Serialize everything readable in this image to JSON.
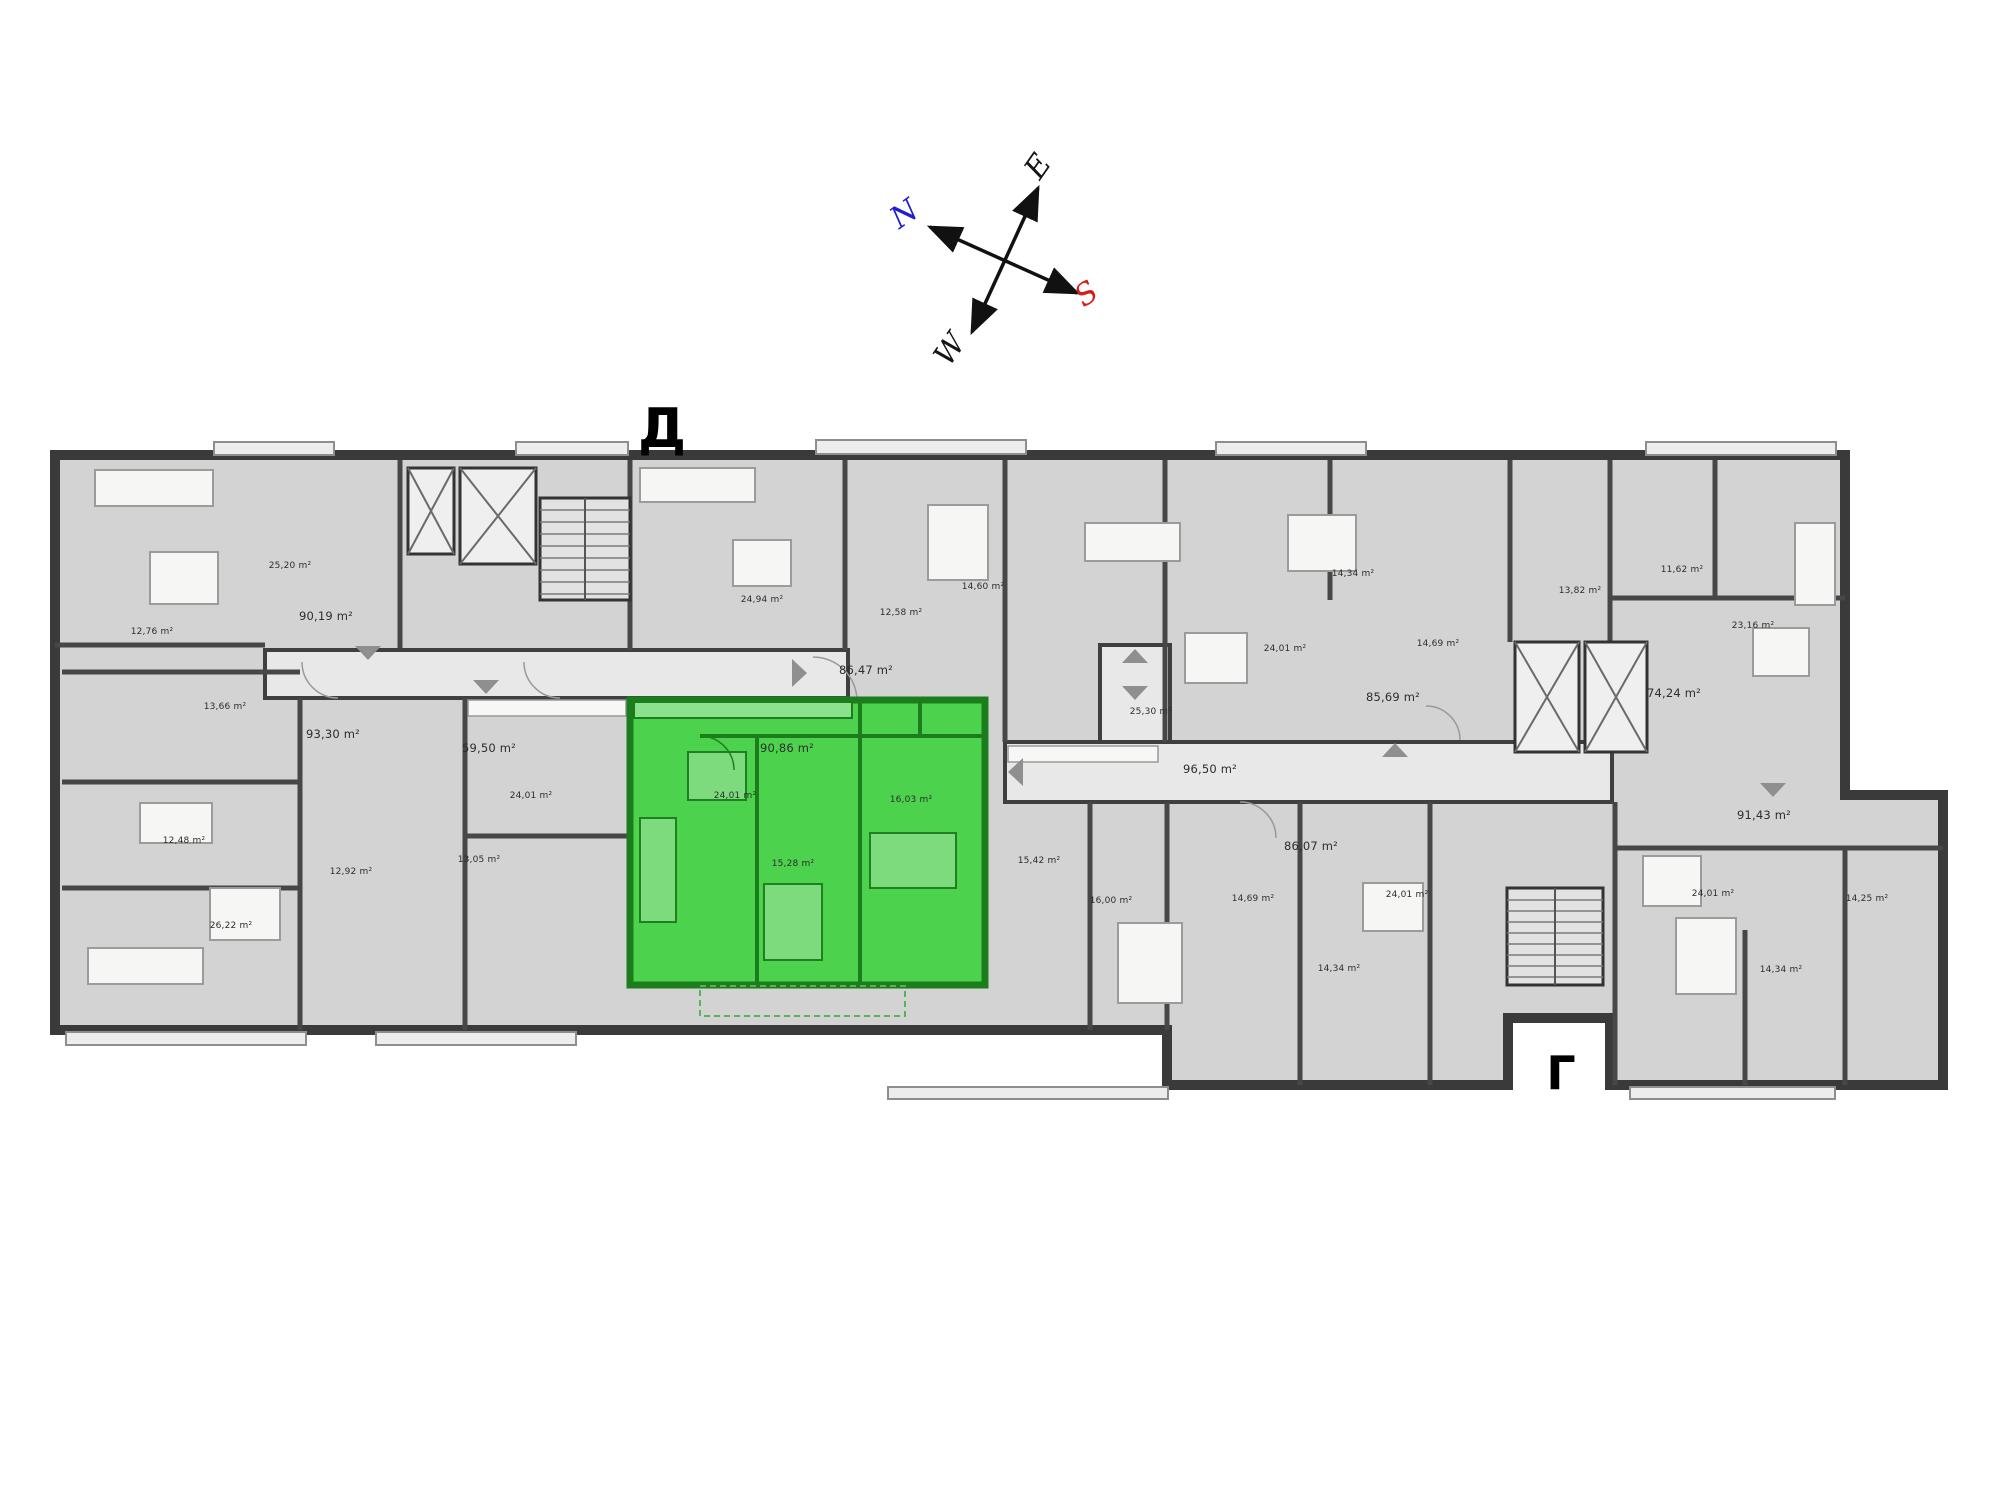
{
  "entrances": {
    "top_label": "Д",
    "bottom_label": "Г"
  },
  "compass": {
    "north": {
      "label": "N",
      "color": "#1f1fd1"
    },
    "east": {
      "label": "E",
      "color": "#151515"
    },
    "south": {
      "label": "S",
      "color": "#d11f1f"
    },
    "west": {
      "label": "W",
      "color": "#151515"
    }
  },
  "palette": {
    "apartment_fill": "#d3d3d3",
    "corridor_fill": "#e8e8e8",
    "wall": "#3a3a3a",
    "highlight_fill": "#4cd24c",
    "highlight_wall": "#1b7d1b"
  },
  "areas": [
    {
      "label": "25,20 m²"
    },
    {
      "label": "90,19 m²"
    },
    {
      "label": "12,76 m²"
    },
    {
      "label": "13,66 m²"
    },
    {
      "label": "93,30 m²"
    },
    {
      "label": "12,48 m²"
    },
    {
      "label": "12,92 m²"
    },
    {
      "label": "26,22 m²"
    },
    {
      "label": "59,50 m²"
    },
    {
      "label": "24,01 m²"
    },
    {
      "label": "13,05 m²"
    },
    {
      "label": "24,94 m²"
    },
    {
      "label": "12,58 m²"
    },
    {
      "label": "14,60 m²"
    },
    {
      "label": "86,47 m²"
    },
    {
      "label": "90,86 m²"
    },
    {
      "label": "24,01 m²"
    },
    {
      "label": "16,03 m²"
    },
    {
      "label": "15,28 m²"
    },
    {
      "label": "25,30 m²"
    },
    {
      "label": "96,50 m²"
    },
    {
      "label": "14,34 m²"
    },
    {
      "label": "24,01 m²"
    },
    {
      "label": "14,69 m²"
    },
    {
      "label": "85,69 m²"
    },
    {
      "label": "13,82 m²"
    },
    {
      "label": "11,62 m²"
    },
    {
      "label": "23,16 m²"
    },
    {
      "label": "74,24 m²"
    },
    {
      "label": "15,42 m²"
    },
    {
      "label": "16,00 m²"
    },
    {
      "label": "14,69 m²"
    },
    {
      "label": "86,07 m²"
    },
    {
      "label": "24,01 m²"
    },
    {
      "label": "14,34 m²"
    },
    {
      "label": "91,43 m²"
    },
    {
      "label": "24,01 m²"
    },
    {
      "label": "14,25 m²"
    },
    {
      "label": "14,34 m²"
    }
  ]
}
